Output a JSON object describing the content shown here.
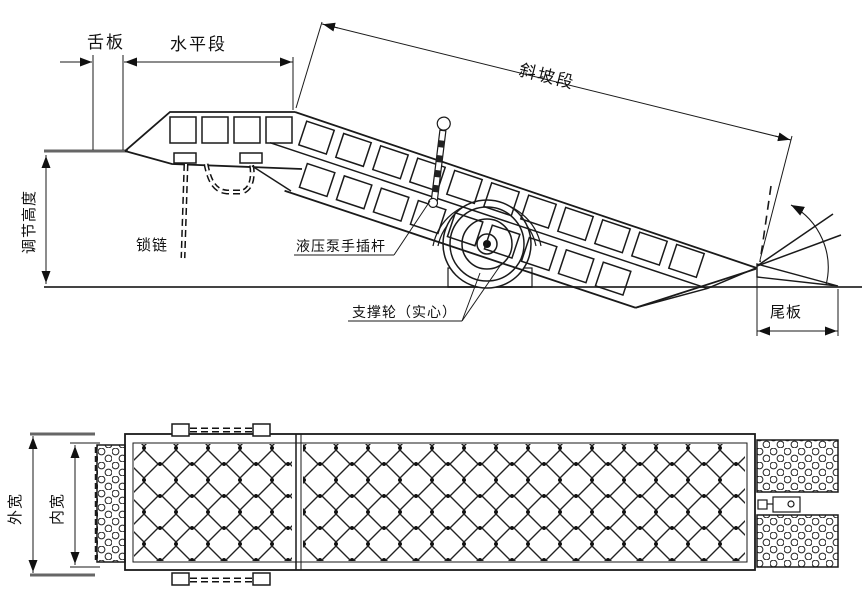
{
  "drawing": {
    "type": "mobile dock ramp technical drawing",
    "colors": {
      "line": "#1a1a1a",
      "heavy_line": "#555555",
      "background": "#ffffff"
    },
    "side_view": {
      "labels": {
        "tongue_plate": "舌板",
        "horizontal_section": "水平段",
        "slope_section": "斜坡段",
        "adjust_height": "调节高度",
        "lock_chain": "锁链",
        "pump_rod": "液压泵手插杆",
        "support_wheel": "支撑轮（实心）",
        "tail_plate": "尾板"
      }
    },
    "top_view": {
      "labels": {
        "outer_width": "外宽",
        "inner_width": "内宽"
      }
    }
  }
}
